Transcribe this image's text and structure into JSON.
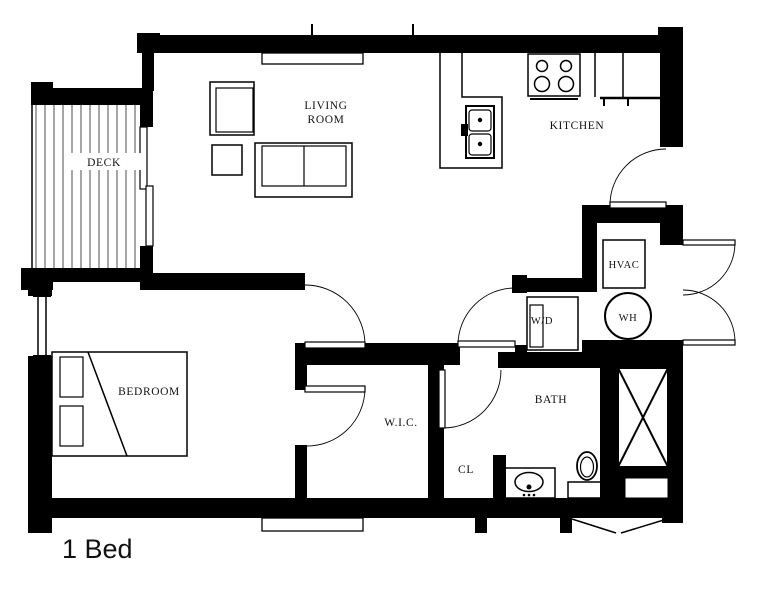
{
  "colors": {
    "wall": "#000000",
    "background": "#ffffff",
    "text": "#111111"
  },
  "plan_title": "1 Bed",
  "labels": {
    "deck": "DECK",
    "living_room_line1": "LIVING",
    "living_room_line2": "ROOM",
    "kitchen": "KITCHEN",
    "bedroom": "BEDROOM",
    "walk_in_closet": "W.I.C.",
    "closet": "CL",
    "bath": "BATH",
    "hvac": "HVAC",
    "water_heater": "WH",
    "washer_dryer": "W/D"
  }
}
